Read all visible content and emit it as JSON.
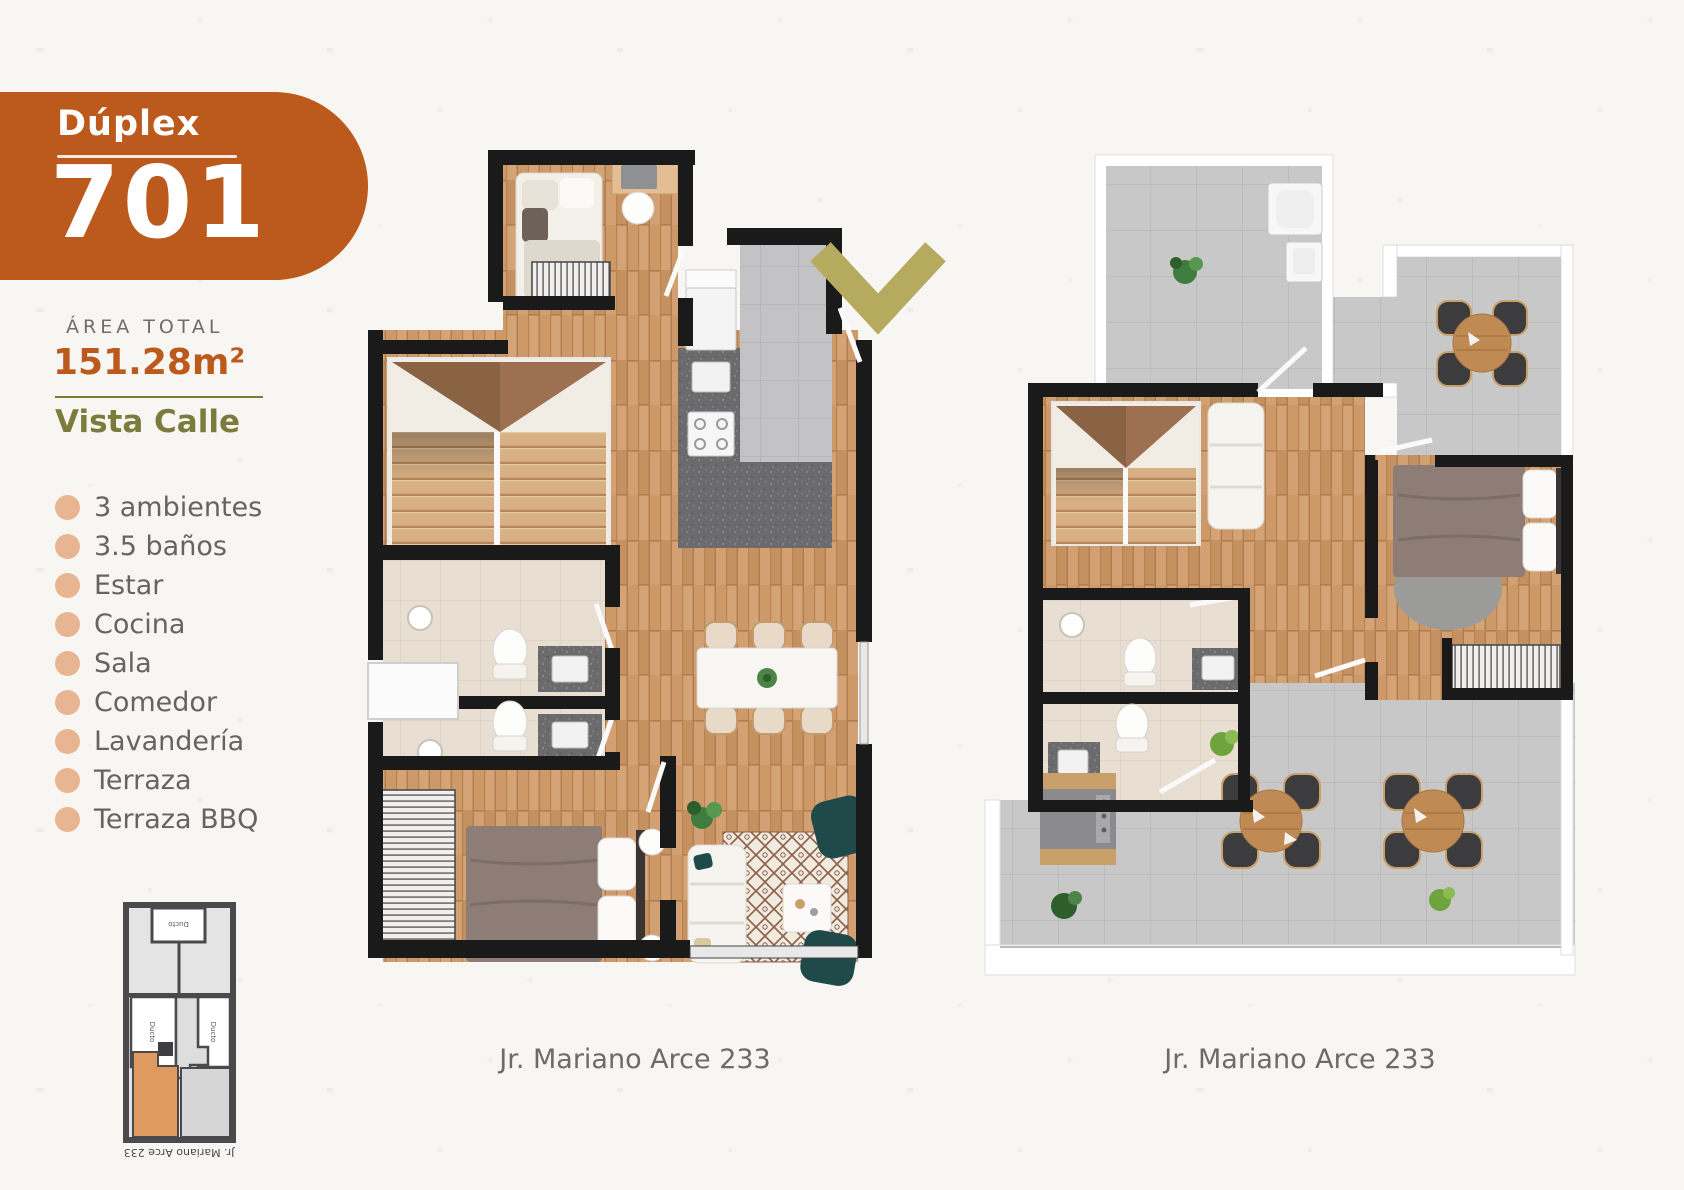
{
  "badge": {
    "type_label": "Dúplex",
    "unit_number": "701",
    "color": "#BC5A1E"
  },
  "area": {
    "label": "ÁREA TOTAL",
    "value": "151.28m²"
  },
  "view": {
    "label": "Vista Calle",
    "color": "#7C7B3C"
  },
  "features": [
    "3 ambientes",
    "3.5 baños",
    "Estar",
    "Cocina",
    "Sala",
    "Comedor",
    "Lavandería",
    "Terraza",
    "Terraza BBQ"
  ],
  "key_plan": {
    "duct_top": "Ducto",
    "duct_left": "Ducto",
    "duct_right": "Ducto",
    "street_label": "Jr. Mariano Arce 233",
    "highlight_color": "#DF9A62"
  },
  "plans": {
    "first": {
      "caption": "Jr. Mariano Arce 233"
    },
    "second": {
      "caption": "Jr. Mariano Arce 233"
    }
  },
  "icons": {
    "entrance_arrow": "chevron-down-icon",
    "arrow_color": "#B5AA5E"
  },
  "colors": {
    "accent_orange": "#BC5A1E",
    "olive": "#7C7B3C",
    "arrow_olive": "#B5AA5E",
    "bullet_peach": "#E7B591",
    "text_gray": "#6B6B6B",
    "wall_black": "#1A1A1A",
    "wood": "#CD9969",
    "tile_gray": "#C8C8C8"
  }
}
